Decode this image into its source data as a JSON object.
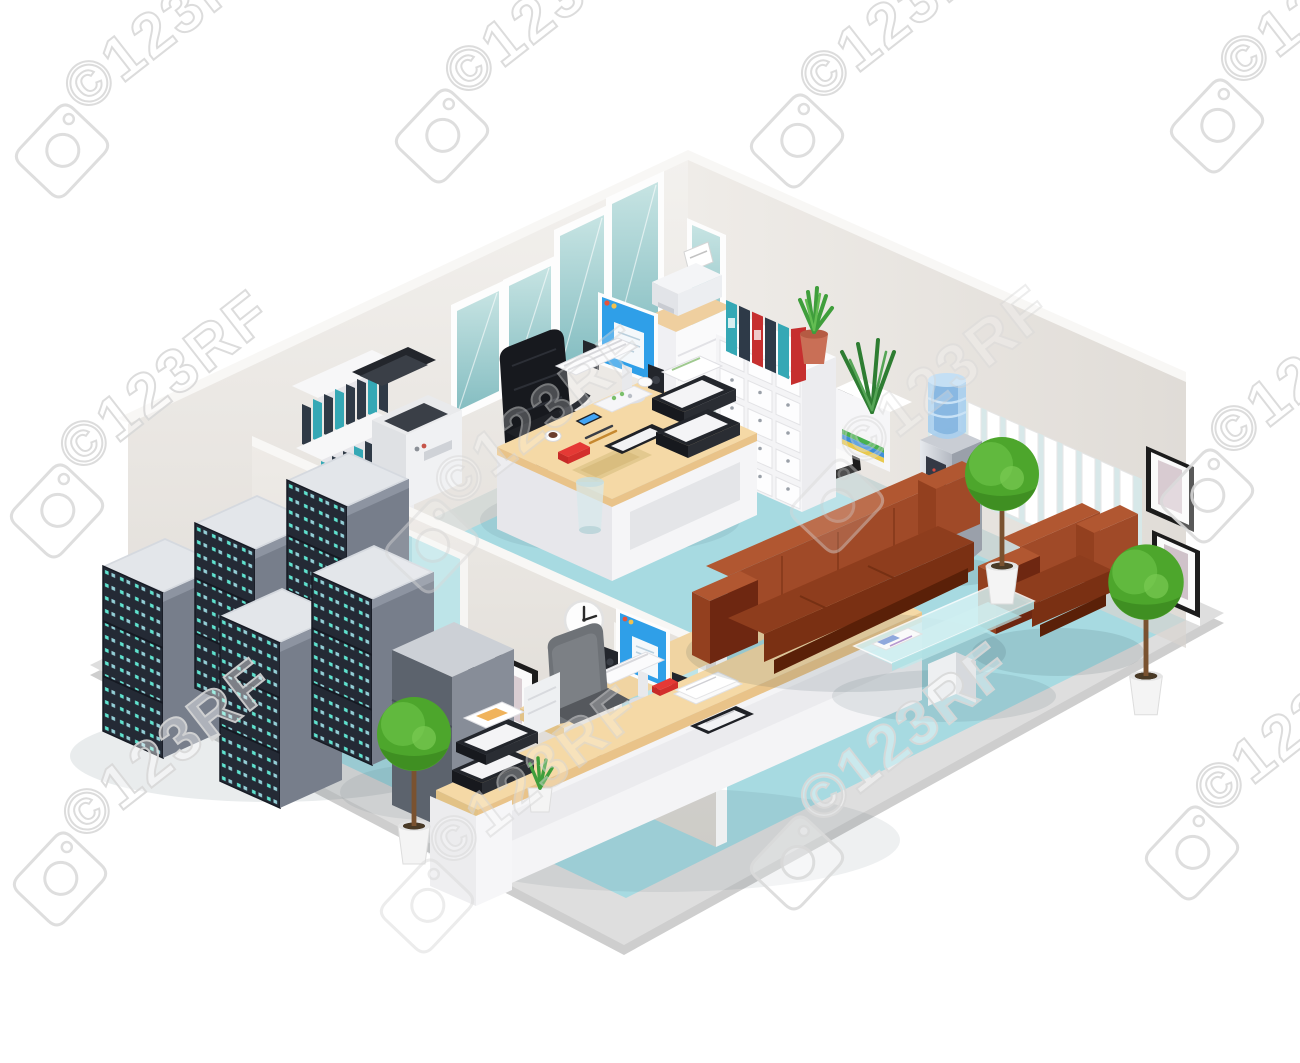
{
  "watermark": {
    "text": "©123RF",
    "outline_color": "#d9d9d9",
    "fill_color": "#ffffff",
    "count_visible": 12
  },
  "palette": {
    "floor_teal": "#a7dae1",
    "floor_rim": "#c6c6c6",
    "platform": "#dedede",
    "wall_warm_grey": "#eae6e2",
    "wall_top": "#f8f7f5",
    "window_glass": "#9cc8cb",
    "sofa_leather": "#a04a28",
    "sofa_dark": "#6e2711",
    "desk_wood": "#f5d9a6",
    "monitor_screen": "#2f9fe8",
    "server_rack_face": "#262c37",
    "server_led": "#5fe3cf",
    "radiator_white": "#ffffff",
    "topiary_green": "#54ae2f",
    "accent_red": "#e53935",
    "binder_teal": "#35a8b5",
    "binder_red": "#c62f2f",
    "binder_navy": "#2e3a48",
    "water_cooler_silver": "#c7cbd2",
    "water_bottle_blue": "#a9cfee"
  },
  "scene": {
    "style": "isometric office interior cutaway illustration",
    "rooms": [
      {
        "name": "office",
        "items": [
          "desk with computer monitor",
          "black office chair",
          "shelf with ring binders",
          "photocopier",
          "card file cabinet",
          "printer on drawer cabinet",
          "colored ring binders",
          "potted aloe",
          "paper trays",
          "windows",
          "trash bin"
        ]
      },
      {
        "name": "server-room",
        "items": [
          "server racks with LED lights",
          "wall poster with beach card",
          "doorway"
        ]
      },
      {
        "name": "reception",
        "items": [
          "reception counter with computer",
          "grey office chair",
          "paper trays",
          "potted aloe",
          "wall clock",
          "picture frame",
          "topiary tree",
          "doorway",
          "pedestal"
        ]
      },
      {
        "name": "waiting-area",
        "items": [
          "brown leather sofa",
          "brown leather armchair",
          "glass coffee table with magazine",
          "water cooler",
          "wall radiator",
          "topiary trees",
          "picture frames"
        ]
      }
    ]
  }
}
